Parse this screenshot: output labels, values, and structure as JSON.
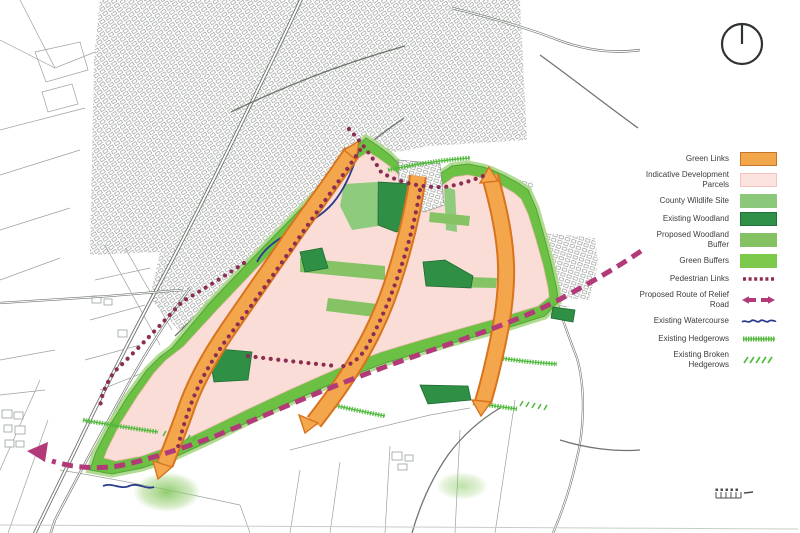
{
  "legend": {
    "items": [
      {
        "label": "Green Links",
        "symbol": "swatch-orange"
      },
      {
        "label": "Indicative Development Parcels",
        "symbol": "swatch-pale-pink"
      },
      {
        "label": "County Wildlife Site",
        "symbol": "swatch-light-green"
      },
      {
        "label": "Existing Woodland",
        "symbol": "swatch-dark-green"
      },
      {
        "label": "Proposed Woodland Buffer",
        "symbol": "swatch-medium-green"
      },
      {
        "label": "Green Buffers",
        "symbol": "swatch-green"
      },
      {
        "label": "Pedestrian Links",
        "symbol": "purple-dotted-line"
      },
      {
        "label": "Proposed Route of Relief Road",
        "symbol": "magenta-dashed-arrows"
      },
      {
        "label": "Existing Watercourse",
        "symbol": "blue-wavy-line"
      },
      {
        "label": "Existing Hedgerows",
        "symbol": "green-scribble-line"
      },
      {
        "label": "Existing Broken Hedgerows",
        "symbol": "green-broken-hatch"
      }
    ]
  },
  "compass": {
    "type": "circle-with-north-line"
  },
  "colors": {
    "legGreenLinks": "#F2A74B",
    "legGreenLinksEdge": "#C8732E",
    "legParcel": "#FBE3DF",
    "legParcelEdge": "#F2C4BB",
    "legWildlife": "#8CC87C",
    "legWoodland": "#2F9147",
    "legWoodlandEdge": "#25703A",
    "legWoodBuffer": "#83C163",
    "legGreenBuffer": "#7CC94B",
    "pedestrian": "#8B2E52",
    "relief": "#B23A79",
    "water": "#2A3A8C",
    "hedge": "#4FB83B",
    "mapPink": "#FADDD7",
    "mapPinkEdge": "#EFB9AF",
    "mapBuffer": "#6CC044",
    "mapBufferLight": "#A8D785",
    "mapBufferEdge": "#4FA637",
    "mapWildlife": "#8FCB7C",
    "mapWoodland": "#2E8F45",
    "mapWoodlandEdge": "#1E6B31",
    "mapWoodBuffer": "#85C364",
    "glFill": "#F4A74C",
    "glEdge": "#D8731E",
    "baseLine": "#9AA29A",
    "roadLine": "#6E746E",
    "urbanLine": "#878D87",
    "frameLine": "#C8CCC8",
    "compass": "#2F332F",
    "scalebar": "#4A4F4A"
  }
}
